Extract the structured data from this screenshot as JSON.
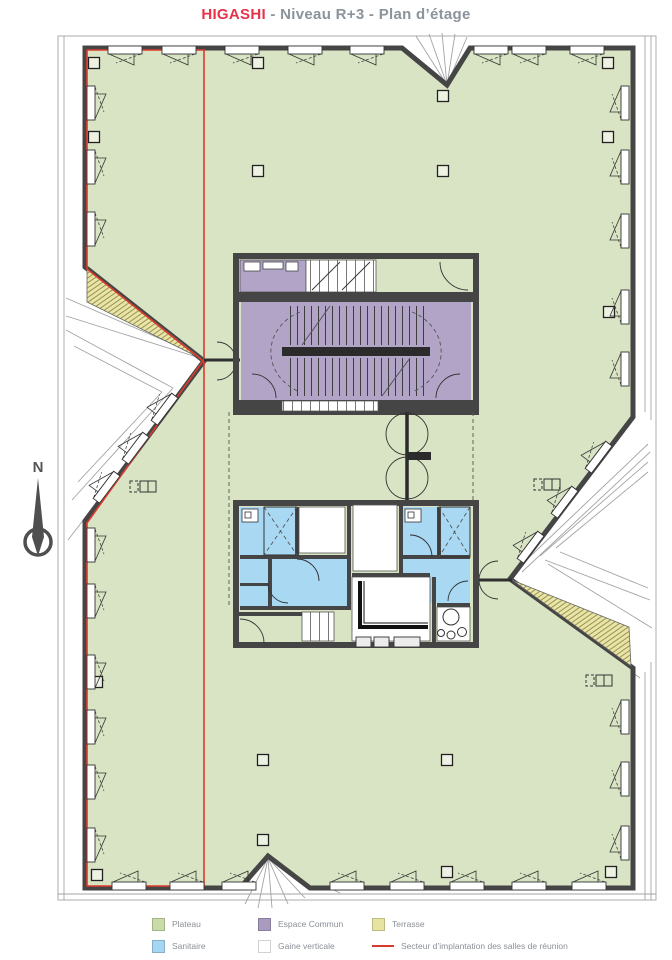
{
  "title": {
    "brand": "HIGASHI",
    "rest": " - Niveau R+3 - Plan d’étage"
  },
  "compass": {
    "label": "N"
  },
  "legend": {
    "items": [
      {
        "key": "plateau",
        "label": "Plateau",
        "color": "#c9dca7",
        "type": "swatch"
      },
      {
        "key": "espace-commun",
        "label": "Espace Commun",
        "color": "#a89bbf",
        "type": "swatch"
      },
      {
        "key": "terrasse",
        "label": "Terrasse",
        "color": "#e7e3a0",
        "type": "swatch"
      },
      {
        "key": "sanitaire",
        "label": "Sanitaire",
        "color": "#a5d6f2",
        "type": "swatch"
      },
      {
        "key": "gaine-verticale",
        "label": "Gaine verticale",
        "color": "#ffffff",
        "type": "swatch"
      },
      {
        "key": "secteur",
        "label": "Secteur d’implantation des salles de réunion",
        "color": "#d93a2e",
        "type": "line"
      }
    ]
  },
  "colors": {
    "plateau": "#d8e4c3",
    "espace_commun": "#b1a4c6",
    "sanitaire": "#a9d8f3",
    "terrasse": "#e9e5a6",
    "wall": "#454545",
    "secteur": "#dd3a2e",
    "title_brand": "#e73248",
    "title_text": "#8b939b",
    "legend_text": "#8a8f96"
  }
}
